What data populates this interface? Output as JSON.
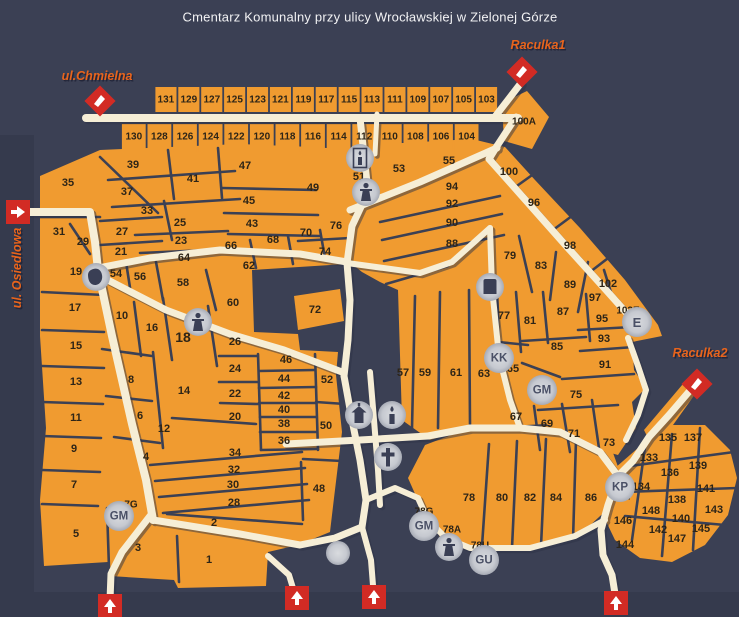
{
  "title": "Cmentarz Komunalny przy ulicy Wrocławskiej w Zielonej Górze",
  "colors": {
    "background": "#3b4054",
    "band": "#353a4d",
    "section_fill": "#f09b30",
    "walkway": "#f6eed6",
    "walkway_shadow": "#2f3447",
    "section_label": "#2e2517",
    "street_label": "#e8641c",
    "street_shadow": "#23263a",
    "marker_red": "#d22b24",
    "circle_fill": "#c6c9d0",
    "circle_text": "#4a5066",
    "title_text": "#f2f2f4"
  },
  "streets": [
    {
      "id": "chmielna",
      "label": "ul.Chmielna",
      "x": 97,
      "y": 76,
      "rotate": 0
    },
    {
      "id": "osiedlowa",
      "label": "ul. Osiedlowa",
      "x": 17,
      "y": 268,
      "rotate": -90
    },
    {
      "id": "raculka1",
      "label": "Raculka1",
      "x": 538,
      "y": 45,
      "rotate": 0
    },
    {
      "id": "raculka2",
      "label": "Raculka2",
      "x": 700,
      "y": 353,
      "rotate": 0
    }
  ],
  "strip_rows": {
    "row1": [
      "131",
      "129",
      "127",
      "125",
      "123",
      "121",
      "119",
      "117",
      "115",
      "113",
      "111",
      "109",
      "107",
      "105",
      "103"
    ],
    "row2": [
      "130",
      "128",
      "126",
      "124",
      "122",
      "120",
      "118",
      "116",
      "114",
      "112",
      "110",
      "108",
      "106",
      "104"
    ]
  },
  "sections": [
    {
      "n": "100A",
      "x": 524,
      "y": 122,
      "s": 10
    },
    {
      "n": "35",
      "x": 68,
      "y": 183
    },
    {
      "n": "39",
      "x": 133,
      "y": 165
    },
    {
      "n": "37",
      "x": 127,
      "y": 192
    },
    {
      "n": "41",
      "x": 193,
      "y": 179
    },
    {
      "n": "47",
      "x": 245,
      "y": 166
    },
    {
      "n": "45",
      "x": 249,
      "y": 201
    },
    {
      "n": "43",
      "x": 252,
      "y": 224
    },
    {
      "n": "33",
      "x": 147,
      "y": 211
    },
    {
      "n": "25",
      "x": 180,
      "y": 223
    },
    {
      "n": "31",
      "x": 59,
      "y": 232
    },
    {
      "n": "27",
      "x": 122,
      "y": 232
    },
    {
      "n": "29",
      "x": 83,
      "y": 242
    },
    {
      "n": "23",
      "x": 181,
      "y": 241
    },
    {
      "n": "21",
      "x": 121,
      "y": 252
    },
    {
      "n": "64",
      "x": 184,
      "y": 258
    },
    {
      "n": "66",
      "x": 231,
      "y": 246
    },
    {
      "n": "68",
      "x": 273,
      "y": 240
    },
    {
      "n": "70",
      "x": 306,
      "y": 233
    },
    {
      "n": "76",
      "x": 336,
      "y": 226
    },
    {
      "n": "74",
      "x": 325,
      "y": 252
    },
    {
      "n": "62",
      "x": 249,
      "y": 266
    },
    {
      "n": "49",
      "x": 313,
      "y": 188
    },
    {
      "n": "51",
      "x": 359,
      "y": 177
    },
    {
      "n": "53",
      "x": 399,
      "y": 169
    },
    {
      "n": "55",
      "x": 449,
      "y": 161
    },
    {
      "n": "19",
      "x": 76,
      "y": 272
    },
    {
      "n": "54",
      "x": 116,
      "y": 274
    },
    {
      "n": "56",
      "x": 140,
      "y": 277
    },
    {
      "n": "58",
      "x": 183,
      "y": 283
    },
    {
      "n": "60",
      "x": 233,
      "y": 303
    },
    {
      "n": "72",
      "x": 315,
      "y": 310
    },
    {
      "n": "17",
      "x": 75,
      "y": 308
    },
    {
      "n": "10",
      "x": 122,
      "y": 316
    },
    {
      "n": "16",
      "x": 152,
      "y": 328
    },
    {
      "n": "18",
      "x": 183,
      "y": 337,
      "s": 14
    },
    {
      "n": "26",
      "x": 235,
      "y": 342
    },
    {
      "n": "8",
      "x": 131,
      "y": 380
    },
    {
      "n": "14",
      "x": 184,
      "y": 391
    },
    {
      "n": "6",
      "x": 140,
      "y": 416
    },
    {
      "n": "12",
      "x": 164,
      "y": 429
    },
    {
      "n": "4",
      "x": 146,
      "y": 457
    },
    {
      "n": "15",
      "x": 76,
      "y": 346
    },
    {
      "n": "13",
      "x": 76,
      "y": 382
    },
    {
      "n": "11",
      "x": 76,
      "y": 418
    },
    {
      "n": "9",
      "x": 74,
      "y": 449
    },
    {
      "n": "7",
      "x": 74,
      "y": 485
    },
    {
      "n": "5",
      "x": 76,
      "y": 534
    },
    {
      "n": "3",
      "x": 138,
      "y": 548
    },
    {
      "n": "2",
      "x": 214,
      "y": 523
    },
    {
      "n": "1",
      "x": 209,
      "y": 560
    },
    {
      "n": "24",
      "x": 235,
      "y": 369
    },
    {
      "n": "22",
      "x": 235,
      "y": 394
    },
    {
      "n": "20",
      "x": 235,
      "y": 417
    },
    {
      "n": "34",
      "x": 235,
      "y": 453
    },
    {
      "n": "32",
      "x": 234,
      "y": 470
    },
    {
      "n": "30",
      "x": 233,
      "y": 485
    },
    {
      "n": "28",
      "x": 234,
      "y": 503
    },
    {
      "n": "46",
      "x": 286,
      "y": 360
    },
    {
      "n": "44",
      "x": 284,
      "y": 379
    },
    {
      "n": "42",
      "x": 284,
      "y": 396
    },
    {
      "n": "40",
      "x": 284,
      "y": 410
    },
    {
      "n": "38",
      "x": 284,
      "y": 424
    },
    {
      "n": "36",
      "x": 284,
      "y": 441
    },
    {
      "n": "52",
      "x": 327,
      "y": 380
    },
    {
      "n": "50",
      "x": 326,
      "y": 426
    },
    {
      "n": "48",
      "x": 319,
      "y": 489
    },
    {
      "n": "7G",
      "x": 131,
      "y": 505,
      "s": 10
    },
    {
      "n": "94",
      "x": 452,
      "y": 187
    },
    {
      "n": "92",
      "x": 452,
      "y": 204
    },
    {
      "n": "90",
      "x": 452,
      "y": 223
    },
    {
      "n": "88",
      "x": 452,
      "y": 244
    },
    {
      "n": "100",
      "x": 509,
      "y": 172
    },
    {
      "n": "96",
      "x": 534,
      "y": 203
    },
    {
      "n": "98",
      "x": 570,
      "y": 246
    },
    {
      "n": "102",
      "x": 608,
      "y": 284
    },
    {
      "n": "97",
      "x": 595,
      "y": 298
    },
    {
      "n": "89",
      "x": 570,
      "y": 285
    },
    {
      "n": "79",
      "x": 510,
      "y": 256
    },
    {
      "n": "83",
      "x": 541,
      "y": 266
    },
    {
      "n": "57",
      "x": 403,
      "y": 373
    },
    {
      "n": "59",
      "x": 425,
      "y": 373
    },
    {
      "n": "61",
      "x": 456,
      "y": 373
    },
    {
      "n": "63",
      "x": 484,
      "y": 374
    },
    {
      "n": "65",
      "x": 513,
      "y": 369
    },
    {
      "n": "77",
      "x": 504,
      "y": 316
    },
    {
      "n": "81",
      "x": 530,
      "y": 321
    },
    {
      "n": "87",
      "x": 563,
      "y": 312
    },
    {
      "n": "85",
      "x": 557,
      "y": 347
    },
    {
      "n": "95",
      "x": 602,
      "y": 319
    },
    {
      "n": "93",
      "x": 604,
      "y": 339
    },
    {
      "n": "91",
      "x": 605,
      "y": 365
    },
    {
      "n": "102E",
      "x": 628,
      "y": 311,
      "s": 10
    },
    {
      "n": "75",
      "x": 576,
      "y": 395
    },
    {
      "n": "67",
      "x": 516,
      "y": 417
    },
    {
      "n": "69",
      "x": 547,
      "y": 424
    },
    {
      "n": "71",
      "x": 574,
      "y": 434
    },
    {
      "n": "73",
      "x": 609,
      "y": 443
    },
    {
      "n": "78",
      "x": 469,
      "y": 498
    },
    {
      "n": "80",
      "x": 502,
      "y": 498
    },
    {
      "n": "82",
      "x": 530,
      "y": 498
    },
    {
      "n": "84",
      "x": 556,
      "y": 498
    },
    {
      "n": "86",
      "x": 591,
      "y": 498
    },
    {
      "n": "78G",
      "x": 424,
      "y": 512,
      "s": 10
    },
    {
      "n": "78A",
      "x": 452,
      "y": 530,
      "s": 10
    },
    {
      "n": "78U",
      "x": 480,
      "y": 546,
      "s": 10
    },
    {
      "n": "132",
      "x": 622,
      "y": 497,
      "s": 10
    },
    {
      "n": "133",
      "x": 649,
      "y": 458
    },
    {
      "n": "134",
      "x": 641,
      "y": 487
    },
    {
      "n": "135",
      "x": 668,
      "y": 438
    },
    {
      "n": "136",
      "x": 670,
      "y": 473
    },
    {
      "n": "137",
      "x": 693,
      "y": 438
    },
    {
      "n": "138",
      "x": 677,
      "y": 500
    },
    {
      "n": "139",
      "x": 698,
      "y": 466
    },
    {
      "n": "140",
      "x": 681,
      "y": 519
    },
    {
      "n": "141",
      "x": 706,
      "y": 489
    },
    {
      "n": "142",
      "x": 658,
      "y": 530
    },
    {
      "n": "143",
      "x": 714,
      "y": 510
    },
    {
      "n": "144",
      "x": 625,
      "y": 545
    },
    {
      "n": "145",
      "x": 701,
      "y": 529
    },
    {
      "n": "146",
      "x": 623,
      "y": 521
    },
    {
      "n": "147",
      "x": 677,
      "y": 539
    },
    {
      "n": "148",
      "x": 651,
      "y": 511
    }
  ],
  "icons": [
    {
      "name": "monument-icon",
      "glyph": "blob",
      "x": 96,
      "y": 277
    },
    {
      "name": "statue-icon",
      "glyph": "person",
      "x": 198,
      "y": 322
    },
    {
      "name": "lantern-icon",
      "glyph": "lantern",
      "x": 360,
      "y": 158
    },
    {
      "name": "statue-icon",
      "glyph": "person",
      "x": 366,
      "y": 192
    },
    {
      "name": "chapel-icon",
      "glyph": "chapel",
      "x": 359,
      "y": 415
    },
    {
      "name": "candle-icon",
      "glyph": "candle",
      "x": 392,
      "y": 415
    },
    {
      "name": "cross-icon",
      "glyph": "cross",
      "x": 388,
      "y": 457
    },
    {
      "name": "grave-icon",
      "glyph": "grave",
      "x": 490,
      "y": 287
    },
    {
      "name": "statue-icon",
      "glyph": "person",
      "x": 449,
      "y": 547
    },
    {
      "name": "dot-icon",
      "glyph": "none",
      "x": 338,
      "y": 553
    }
  ],
  "badges": [
    {
      "label": "KK",
      "x": 499,
      "y": 358
    },
    {
      "label": "GM",
      "x": 542,
      "y": 390
    },
    {
      "label": "E",
      "x": 637,
      "y": 322
    },
    {
      "label": "KP",
      "x": 620,
      "y": 487
    },
    {
      "label": "GM",
      "x": 119,
      "y": 516
    },
    {
      "label": "GM",
      "x": 424,
      "y": 526
    },
    {
      "label": "GU",
      "x": 484,
      "y": 560
    }
  ],
  "markers": [
    {
      "type": "gate",
      "x": 100,
      "y": 101
    },
    {
      "type": "gate",
      "x": 522,
      "y": 72
    },
    {
      "type": "gate",
      "x": 697,
      "y": 384
    },
    {
      "type": "arrow-right",
      "x": 18,
      "y": 212
    },
    {
      "type": "arrow-up",
      "x": 110,
      "y": 606
    },
    {
      "type": "arrow-up",
      "x": 297,
      "y": 598
    },
    {
      "type": "arrow-up",
      "x": 374,
      "y": 597
    },
    {
      "type": "arrow-up",
      "x": 616,
      "y": 603
    }
  ]
}
